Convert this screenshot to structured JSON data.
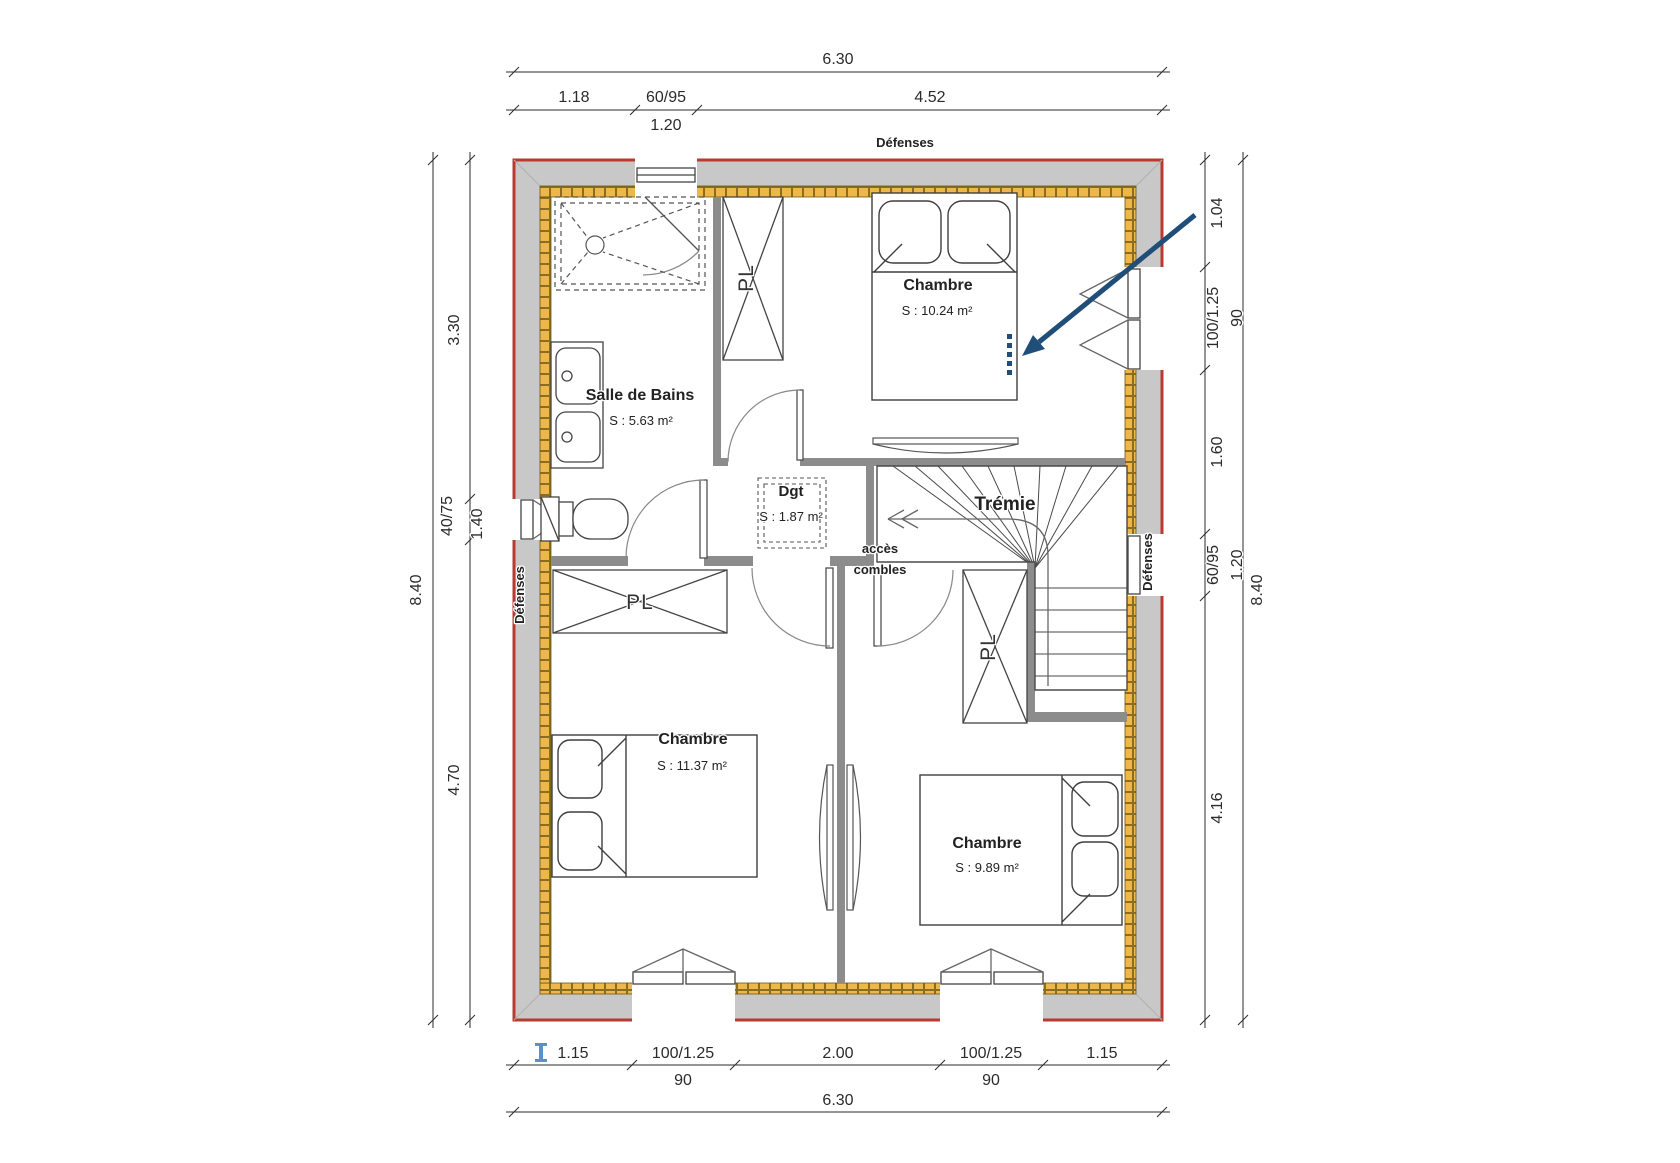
{
  "plan": {
    "labels": {
      "defenses_top": "Défenses",
      "defenses_left": "Défenses",
      "defenses_right": "Défenses",
      "tremie": "Trémie",
      "acces_line1": "accès",
      "acces_line2": "combles",
      "pl_top": "PL",
      "pl_left": "PL",
      "pl_bottom": "PL"
    },
    "rooms": {
      "bathroom": {
        "name": "Salle de Bains",
        "area": "S : 5.63 m²"
      },
      "bedroom_top": {
        "name": "Chambre",
        "area": "S : 10.24 m²"
      },
      "dgt": {
        "name": "Dgt",
        "area": "S : 1.87 m²"
      },
      "bedroom_left": {
        "name": "Chambre",
        "area": "S : 11.37 m²"
      },
      "bedroom_right": {
        "name": "Chambre",
        "area": "S : 9.89 m²"
      }
    },
    "dims": {
      "top_total": "6.30",
      "top_1": "1.18",
      "top_win": "60/95",
      "top_axis": "1.20",
      "top_2": "4.52",
      "left_total": "8.40",
      "left_1": "3.30",
      "left_win": "40/75",
      "left_axis": "1.40",
      "left_2": "4.70",
      "right_1": "1.04",
      "right_win1": "100/1.25",
      "right_axis1": "90",
      "right_2": "1.60",
      "right_win2": "60/95",
      "right_axis2": "1.20",
      "right_3": "4.16",
      "right_total": "8.40",
      "bottom_1": "1.15",
      "bottom_win1": "100/1.25",
      "bottom_axis1": "90",
      "bottom_2": "2.00",
      "bottom_win2": "100/1.25",
      "bottom_axis2": "90",
      "bottom_3": "1.15",
      "bottom_total": "6.30"
    },
    "colors": {
      "outline_red": "#b83b32",
      "wall_gray": "#c8c8c8",
      "partition_gray": "#8c8c8c",
      "insulation_yellow": "#edb74a",
      "annotation_blue": "#1f4e79",
      "cursor_blue": "#4a86c5"
    }
  }
}
